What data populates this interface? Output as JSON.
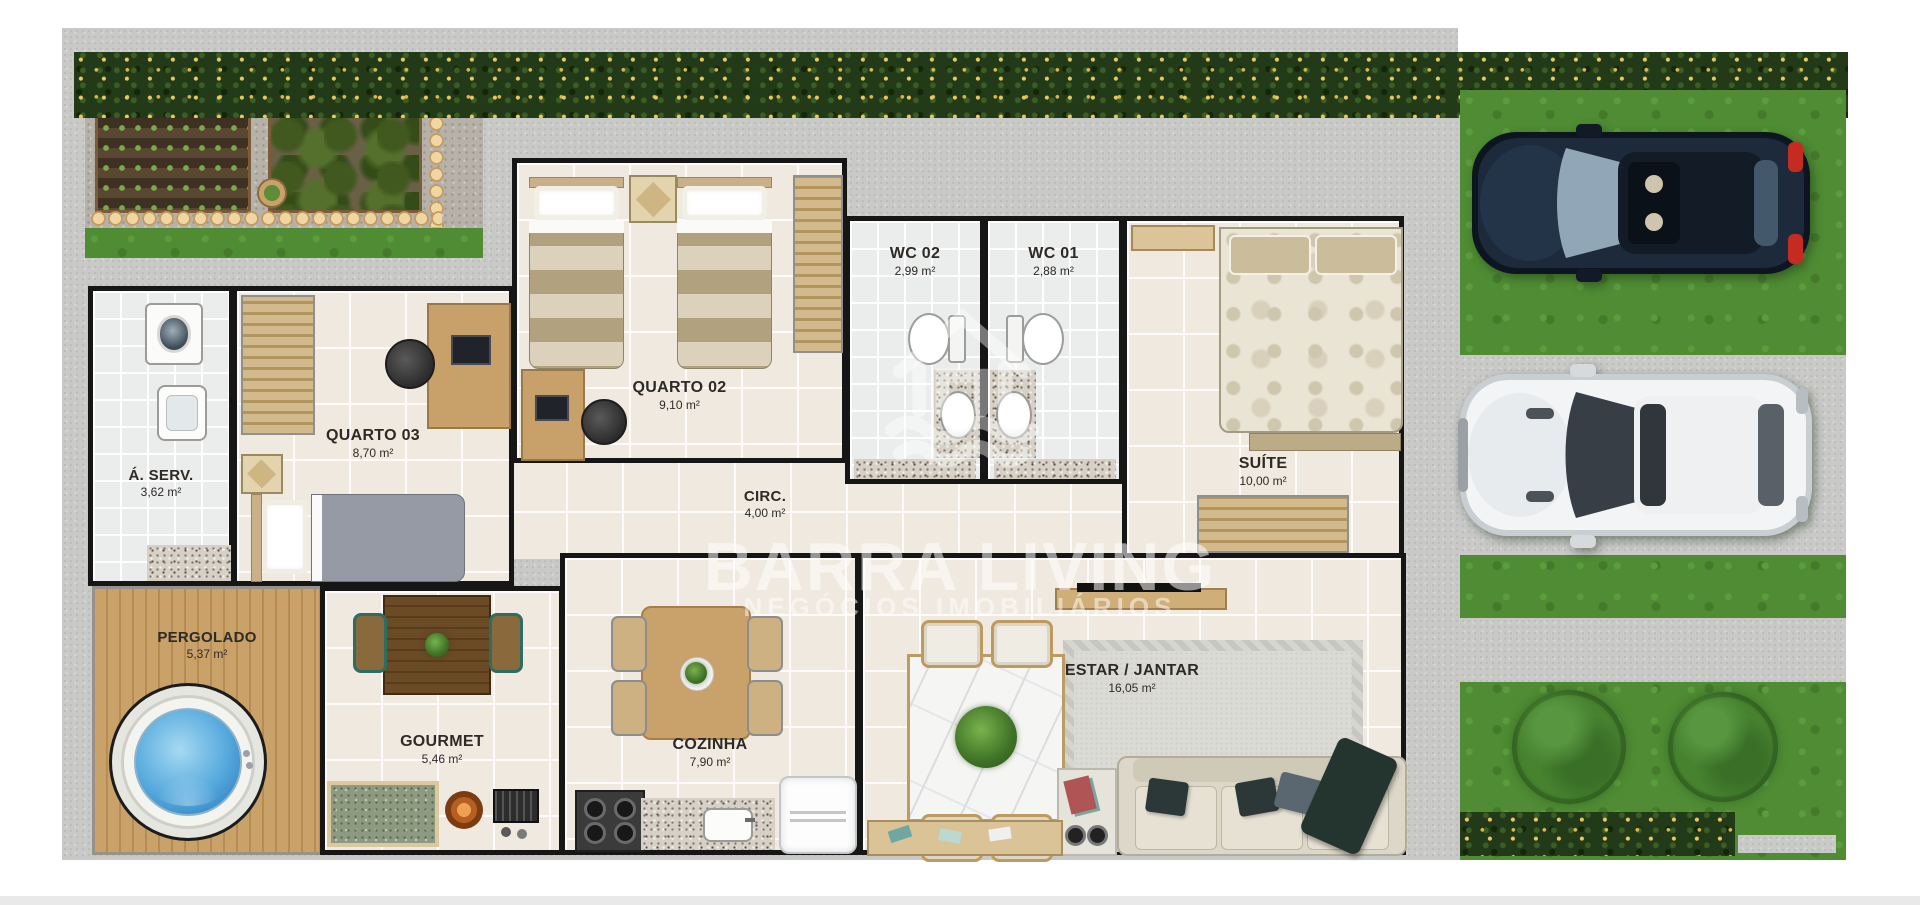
{
  "plan": {
    "watermark": {
      "brand": "BARRA LIVING",
      "tagline": "NEGÓCIOS IMOBILIÁRIOS",
      "logo": "house-waves-icon"
    },
    "rooms": {
      "quarto02": {
        "label": "QUARTO 02",
        "area": "9,10 m²"
      },
      "quarto03": {
        "label": "QUARTO 03",
        "area": "8,70 m²"
      },
      "wc01": {
        "label": "WC 01",
        "area": "2,88 m²"
      },
      "wc02": {
        "label": "WC 02",
        "area": "2,99 m²"
      },
      "suite": {
        "label": "SUÍTE",
        "area": "10,00 m²"
      },
      "aserv": {
        "label": "Á. SERV.",
        "area": "3,62 m²"
      },
      "circ": {
        "label": "CIRC.",
        "area": "4,00 m²"
      },
      "pergolado": {
        "label": "PERGOLADO",
        "area": "5,37 m²"
      },
      "gourmet": {
        "label": "GOURMET",
        "area": "5,46 m²"
      },
      "cozinha": {
        "label": "COZINHA",
        "area": "7,90 m²"
      },
      "estar": {
        "label": "ESTAR / JANTAR",
        "area": "16,05 m²"
      }
    },
    "objects": [
      "dark-car",
      "white-car",
      "hot-tub",
      "round-tree",
      "flower-hedge",
      "vegetable-garden",
      "sofa",
      "dining-table",
      "kitchen-table",
      "gourmet-table",
      "fridge",
      "stove",
      "washer",
      "laundry-sink",
      "toilet",
      "bathroom-sink",
      "twin-bed",
      "single-bed",
      "double-bed",
      "wardrobe",
      "desk",
      "rug"
    ],
    "colors": {
      "wall": "#161616",
      "floor_tile": "#efe9df",
      "concrete": "#c9c9c7",
      "grass": "#4f8c33",
      "hedge": "#223a17",
      "wood_deck": "#c9a269",
      "water": "#55a9dd",
      "dark_car": "#1c2a3c",
      "white_car": "#f4f6f7",
      "label_text": "#2e2a26"
    }
  }
}
